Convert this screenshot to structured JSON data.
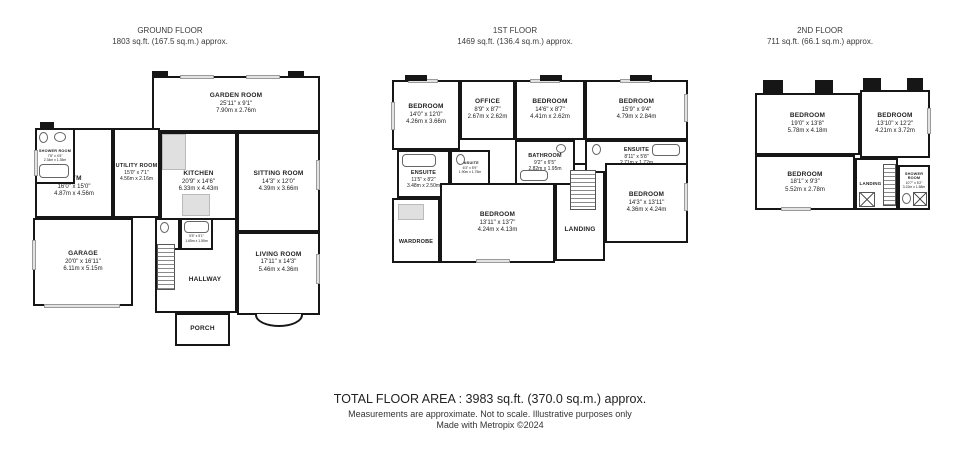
{
  "colors": {
    "wall": "#161616",
    "window_fill": "#e3e3e3",
    "background": "#ffffff"
  },
  "footer": {
    "total": "TOTAL FLOOR AREA : 3983 sq.ft. (370.0 sq.m.) approx.",
    "disclaimer": "Measurements are approximate.  Not to scale.  Illustrative purposes only",
    "credit": "Made with Metropix ©2024"
  },
  "floors": [
    {
      "title": "GROUND FLOOR",
      "area": "1803 sq.ft. (167.5 sq.m.) approx.",
      "rooms": [
        {
          "name": "GARDEN ROOM",
          "dims_ft": "25'11\" x 9'1\"",
          "dims_m": "7.90m x 2.76m"
        },
        {
          "name": "SITTING ROOM",
          "dims_ft": "14'3\" x 12'0\"",
          "dims_m": "4.39m x 3.66m"
        },
        {
          "name": "GYM",
          "dims_ft": "16'0\" x 15'0\"",
          "dims_m": "4.87m x 4.56m"
        },
        {
          "name": "UTILITY ROOM",
          "dims_ft": "15'0\" x 7'1\"",
          "dims_m": "4.56m x 2.16m"
        },
        {
          "name": "KITCHEN",
          "dims_ft": "20'9\" x 14'6\"",
          "dims_m": "6.33m x 4.43m"
        },
        {
          "name": "GARAGE",
          "dims_ft": "20'0\" x 16'11\"",
          "dims_m": "6.11m x 5.15m"
        },
        {
          "name": "HALLWAY"
        },
        {
          "name": "LIVING ROOM",
          "dims_ft": "17'11\" x 14'3\"",
          "dims_m": "5.46m x 4.36m"
        },
        {
          "name": "PORCH"
        },
        {
          "name": "SHOWER ROOM",
          "dims_ft": "7'8\" x 4'5\"",
          "dims_m": "2.34m x 1.35m"
        },
        {
          "name": "SHOWER ROOM",
          "dims_ft": "5'5\" x 5'1\"",
          "dims_m": "1.65m x 1.55m"
        }
      ]
    },
    {
      "title": "1ST FLOOR",
      "area": "1469 sq.ft. (136.4 sq.m.) approx.",
      "rooms": [
        {
          "name": "BEDROOM",
          "dims_ft": "14'0\" x 12'0\"",
          "dims_m": "4.26m x 3.66m"
        },
        {
          "name": "OFFICE",
          "dims_ft": "8'9\" x 8'7\"",
          "dims_m": "2.67m x 2.62m"
        },
        {
          "name": "BEDROOM",
          "dims_ft": "14'6\" x 8'7\"",
          "dims_m": "4.41m x 2.62m"
        },
        {
          "name": "BEDROOM",
          "dims_ft": "15'9\" x 9'4\"",
          "dims_m": "4.79m x 2.84m"
        },
        {
          "name": "LANDING"
        },
        {
          "name": "BATHROOM",
          "dims_ft": "9'2\" x 6'5\"",
          "dims_m": "2.82m x 1.95m"
        },
        {
          "name": "ENSUITE",
          "dims_ft": "11'5\" x 8'2\"",
          "dims_m": "3.48m x 2.50m"
        },
        {
          "name": "ENSUITE",
          "dims_ft": "6'3\" x 5'9\"",
          "dims_m": "1.90m x 1.75m"
        },
        {
          "name": "ENSUITE",
          "dims_ft": "8'11\" x 5'8\"",
          "dims_m": "2.71m x 1.72m"
        },
        {
          "name": "WARDROBE"
        },
        {
          "name": "BEDROOM",
          "dims_ft": "13'11\" x 13'7\"",
          "dims_m": "4.24m x 4.13m"
        },
        {
          "name": "BEDROOM",
          "dims_ft": "14'3\" x 13'11\"",
          "dims_m": "4.36m x 4.24m"
        }
      ]
    },
    {
      "title": "2ND FLOOR",
      "area": "711 sq.ft. (66.1 sq.m.) approx.",
      "rooms": [
        {
          "name": "BEDROOM",
          "dims_ft": "19'0\" x 13'8\"",
          "dims_m": "5.78m x 4.18m"
        },
        {
          "name": "BEDROOM",
          "dims_ft": "13'10\" x 12'2\"",
          "dims_m": "4.21m x 3.72m"
        },
        {
          "name": "BEDROOM",
          "dims_ft": "18'1\" x 9'3\"",
          "dims_m": "5.52m x 2.78m"
        },
        {
          "name": "LANDING"
        },
        {
          "name": "SHOWER ROOM",
          "dims_ft": "10'7\" x 5'2\"",
          "dims_m": "3.22m x 1.58m"
        }
      ]
    }
  ]
}
